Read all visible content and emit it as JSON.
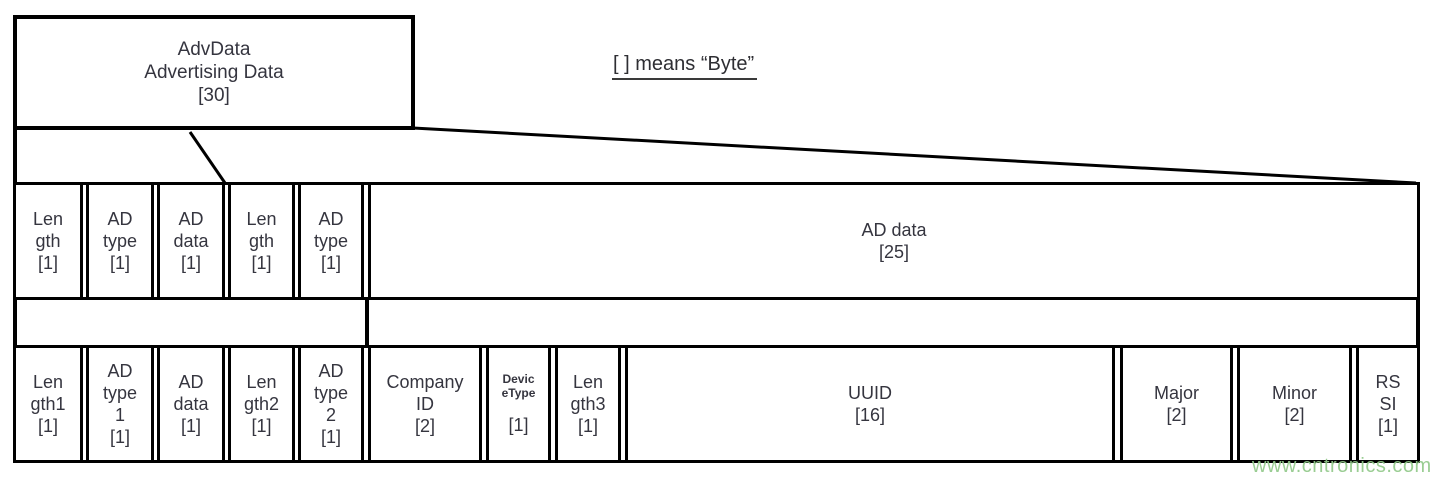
{
  "title_box": {
    "lines": [
      "AdvData",
      "Advertising Data",
      "[30]"
    ]
  },
  "legend_note": {
    "text": "[ ] means “Byte”"
  },
  "ad_structure_row": {
    "cells": [
      {
        "lines": [
          "Len",
          "gth",
          "[1]"
        ]
      },
      {
        "lines": [
          "AD",
          "type",
          "[1]"
        ]
      },
      {
        "lines": [
          "AD",
          "data",
          "[1]"
        ]
      },
      {
        "lines": [
          "Len",
          "gth",
          "[1]"
        ]
      },
      {
        "lines": [
          "AD",
          "type",
          "[1]"
        ]
      },
      {
        "lines": [
          "AD data",
          "[25]"
        ]
      }
    ]
  },
  "ibeacon_row": {
    "cells": [
      {
        "lines": [
          "Len",
          "gth1",
          "[1]"
        ]
      },
      {
        "lines": [
          "AD",
          "type",
          "1",
          "[1]"
        ]
      },
      {
        "lines": [
          "AD",
          "data",
          "[1]"
        ]
      },
      {
        "lines": [
          "Len",
          "gth2",
          "[1]"
        ]
      },
      {
        "lines": [
          "AD",
          "type",
          "2",
          "[1]"
        ]
      },
      {
        "lines": [
          "Company",
          "ID",
          "[2]"
        ]
      },
      {
        "small_lines": [
          "Devic",
          "eType"
        ],
        "size_label": "[1]"
      },
      {
        "lines": [
          "Len",
          "gth3",
          "[1]"
        ]
      },
      {
        "lines": [
          "UUID",
          "[16]"
        ]
      },
      {
        "lines": [
          "Major",
          "[2]"
        ]
      },
      {
        "lines": [
          "Minor",
          "[2]"
        ]
      },
      {
        "lines": [
          "RS",
          "SI",
          "[1]"
        ]
      }
    ]
  },
  "watermark": {
    "text": "www.cntronics.com",
    "color": "#92c98a"
  },
  "colors": {
    "line": "#000000",
    "text": "#35353f",
    "background": "#ffffff"
  }
}
